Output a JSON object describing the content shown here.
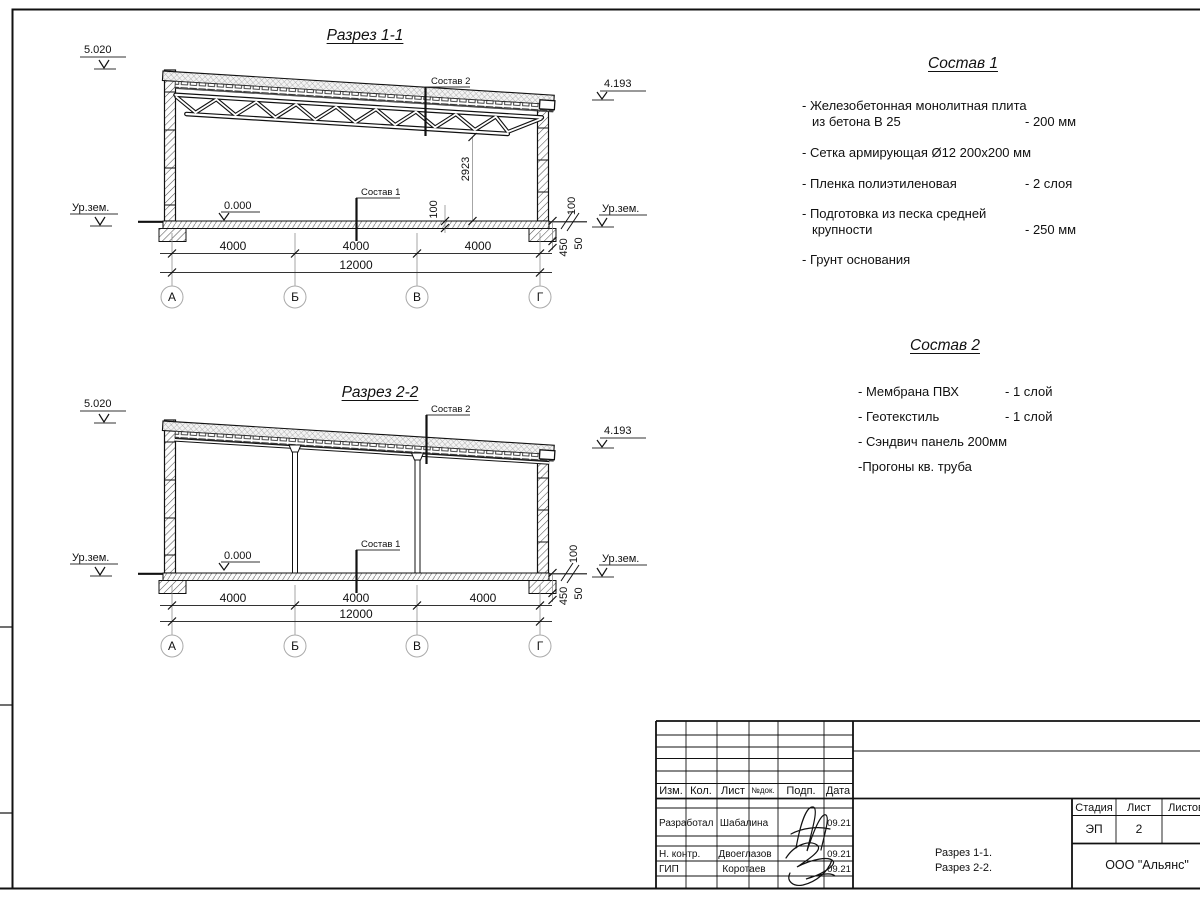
{
  "drawing": {
    "s1": {
      "title": "Разрез 1-1",
      "elev_left": "5.020",
      "elev_right": "4.193",
      "zero": "0.000",
      "ground_left": "Ур.зем.",
      "ground_right": "Ур.зем.",
      "callout_roof": "Состав 2",
      "callout_floor": "Состав 1",
      "truss_height": "2923",
      "floor_100": "100",
      "right_100": "100",
      "right_450": "450",
      "right_50": "50",
      "span1": "4000",
      "span2": "4000",
      "span3": "4000",
      "total": "12000",
      "axis1": "А",
      "axis2": "Б",
      "axis3": "В",
      "axis4": "Г"
    },
    "s2": {
      "title": "Разрез 2-2",
      "elev_left": "5.020",
      "elev_right": "4.193",
      "zero": "0.000",
      "ground_left": "Ур.зем.",
      "ground_right": "Ур.зем.",
      "callout_roof": "Состав 2",
      "callout_floor": "Состав 1",
      "right_100": "100",
      "right_450": "450",
      "right_50": "50",
      "span1": "4000",
      "span2": "4000",
      "span3": "4000",
      "total": "12000",
      "axis1": "А",
      "axis2": "Б",
      "axis3": "В",
      "axis4": "Г"
    }
  },
  "specs": [
    {
      "title": "Состав 1",
      "items": [
        {
          "line1": "- Железобетонная  монолитная плита",
          "line2": "из бетона В 25",
          "value": "- 200 мм"
        },
        {
          "line1": "- Сетка армирующая Ø12 200х200 мм",
          "line2": "",
          "value": ""
        },
        {
          "line1": "- Пленка полиэтиленовая",
          "line2": "",
          "value": "-  2 слоя"
        },
        {
          "line1": "- Подготовка из песка средней",
          "line2": "крупности",
          "value": "- 250 мм"
        },
        {
          "line1": "- Грунт основания",
          "line2": "",
          "value": ""
        }
      ]
    },
    {
      "title": "Состав 2",
      "items": [
        {
          "line1": "- Мембрана ПВХ",
          "line2": "",
          "value": "- 1 слой"
        },
        {
          "line1": "- Геотекстиль",
          "line2": "",
          "value": "- 1 слой"
        },
        {
          "line1": "- Сэндвич панель 200мм",
          "line2": "",
          "value": ""
        },
        {
          "line1": "-Прогоны кв. труба",
          "line2": "",
          "value": ""
        }
      ]
    }
  ],
  "titleblock": {
    "headers": [
      "Изм.",
      "Кол.",
      "Лист",
      "№док.",
      "Подп.",
      "Дата"
    ],
    "rows": [
      {
        "role": "Разработал",
        "name": "Шабалина",
        "date": "09.21"
      },
      {
        "role": "Н. контр.",
        "name": "Двоеглазов",
        "date": "09.21"
      },
      {
        "role": "ГИП",
        "name": "Коротаев",
        "date": "09.21"
      }
    ],
    "stage_label": "Стадия",
    "sheet_label": "Лист",
    "sheets_label": "Листов",
    "stage": "ЭП",
    "sheet_number": "2",
    "doc_line1": "Разрез 1-1.",
    "doc_line2": "Разрез 2-2.",
    "company": "ООО \"Альянс\""
  }
}
